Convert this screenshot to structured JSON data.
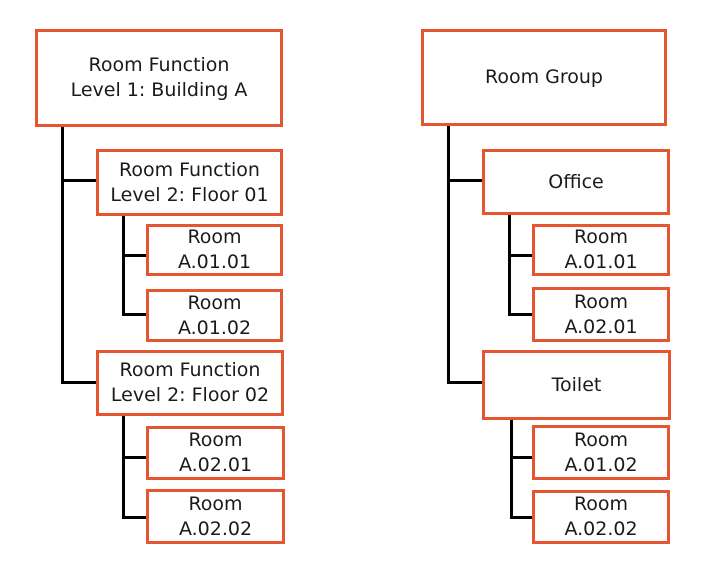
{
  "colors": {
    "box_border": "#E5552F",
    "connector": "#000000",
    "text": "#1a1a1a",
    "background": "#ffffff"
  },
  "left_tree": {
    "nodes": {
      "root": "Room Function\nLevel 1: Building A",
      "floor01": "Room Function\nLevel 2: Floor 01",
      "floor01_room1": "Room\nA.01.01",
      "floor01_room2": "Room\nA.01.02",
      "floor02": "Room Function\nLevel 2: Floor 02",
      "floor02_room1": "Room\nA.02.01",
      "floor02_room2": "Room\nA.02.02"
    }
  },
  "right_tree": {
    "nodes": {
      "root": "Room Group",
      "office": "Office",
      "office_room1": "Room\nA.01.01",
      "office_room2": "Room\nA.02.01",
      "toilet": "Toilet",
      "toilet_room1": "Room\nA.01.02",
      "toilet_room2": "Room\nA.02.02"
    }
  }
}
